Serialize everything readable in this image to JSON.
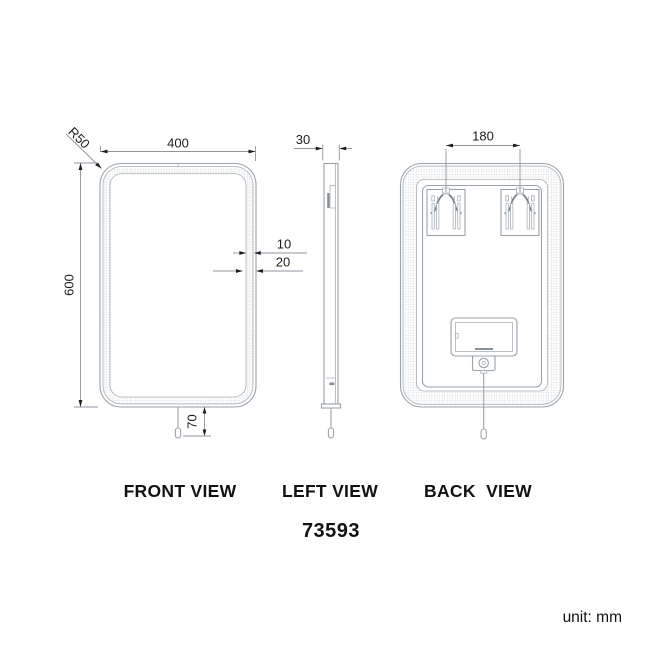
{
  "drawing": {
    "product_code": "73593",
    "unit_note": "unit: mm",
    "views": {
      "front": {
        "label": "FRONT VIEW",
        "dims": {
          "width": "400",
          "height": "600",
          "corner_radius": "R50",
          "strip_width": "10",
          "frame_width": "20",
          "cord_length": "70"
        }
      },
      "left": {
        "label": "LEFT VIEW",
        "dims": {
          "depth": "30"
        }
      },
      "back": {
        "label": "BACK  VIEW",
        "dims": {
          "bracket_spacing": "180"
        }
      }
    },
    "colors": {
      "object_line": "#9aa3ab",
      "dim_line": "#8f959c",
      "ink": "#1d1d1f",
      "hatch": "#c9cfd4",
      "background": "#ffffff"
    }
  }
}
